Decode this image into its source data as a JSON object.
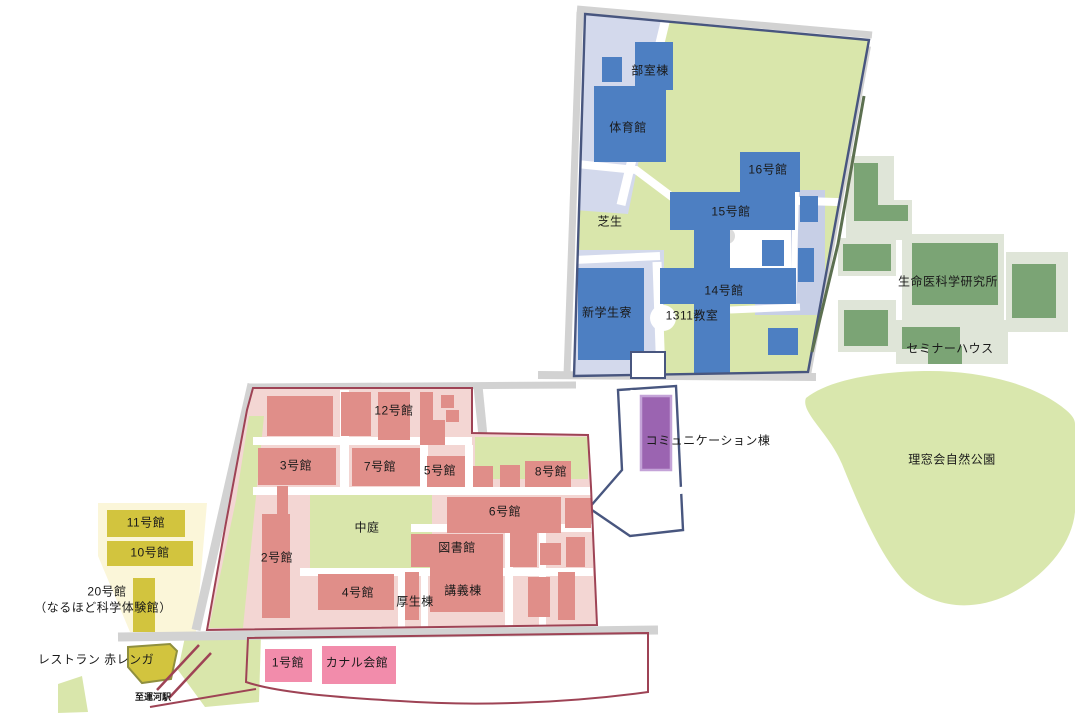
{
  "map": {
    "labels": {
      "club_building": "部室棟",
      "gymnasium": "体育館",
      "bldg16": "16号館",
      "bldg15": "15号館",
      "lawn": "芝生",
      "bldg14": "14号館",
      "new_dorm": "新学生寮",
      "room1311": "1311教室",
      "biomedical_institute": "生命医科学研究所",
      "seminar_house": "セミナーハウス",
      "nature_park": "理窓会自然公園",
      "communication_bldg": "コミュニケーション棟",
      "bldg12": "12号館",
      "bldg3": "3号館",
      "bldg7": "7号館",
      "bldg5": "5号館",
      "bldg8": "8号館",
      "bldg6": "6号館",
      "courtyard": "中庭",
      "library": "図書館",
      "bldg2": "2号館",
      "bldg4": "4号館",
      "welfare_bldg": "厚生棟",
      "lecture_bldg": "講義棟",
      "bldg11": "11号館",
      "bldg10": "10号館",
      "bldg20": "20号館",
      "bldg20_sub": "（なるほど科学体験館）",
      "restaurant": "レストラン 赤レンガ",
      "bldg1": "1号館",
      "canal_hall": "カナル会館",
      "to_station": "至運河駅"
    },
    "colors": {
      "blue": "#4d7fc2",
      "lavender": "#d3d9ec",
      "lavender2": "#c7cfe6",
      "lawn": "#d9e6ab",
      "park": "#d9e7ad",
      "sage": "#dfe5d8",
      "green-bldg": "#7ba475",
      "green-line": "#5c7050",
      "navy": "#48567f",
      "pink-bg": "#f3d6d3",
      "pink-bldg": "#e08e89",
      "red": "#9e4355",
      "yellow-bg": "#fbf6d9",
      "yellow-bldg": "#d2c43e",
      "olive": "#8f8f3f",
      "spink-bg": "#f9d8e2",
      "spink-bldg": "#f28cab",
      "purple": "#9b64b1",
      "purple-border": "#c4a3d8",
      "road": "#d2d2d2",
      "text": "#1a1a1a"
    }
  }
}
